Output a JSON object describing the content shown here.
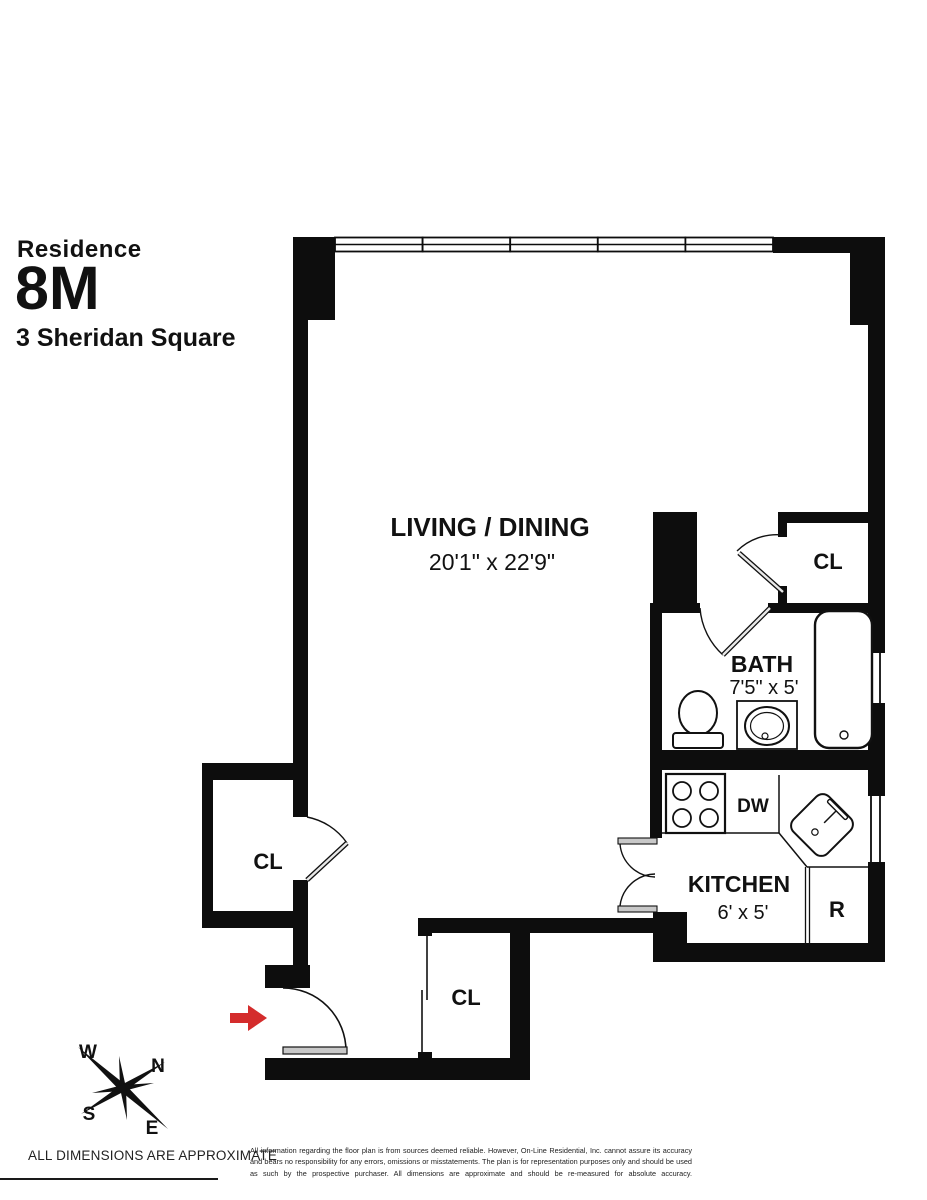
{
  "title": {
    "label": "Residence",
    "unit": "8M",
    "address": "3 Sheridan Square"
  },
  "rooms": {
    "living": {
      "name": "LIVING / DINING",
      "dims": "20'1\" x 22'9\""
    },
    "bath": {
      "name": "BATH",
      "dims": "7'5\" x 5'"
    },
    "kitchen": {
      "name": "KITCHEN",
      "dims": "6' x 5'"
    },
    "closet": "CL"
  },
  "labels": {
    "dishwasher": "DW",
    "refrigerator": "R"
  },
  "compass": {
    "west": "W",
    "north": "N",
    "south": "S",
    "east": "E"
  },
  "footer": {
    "note": "ALL DIMENSIONS ARE APPROXIMATE",
    "disclaimer": "All information regarding the floor plan is from sources deemed reliable. However, On-Line Residential, Inc. cannot assure its accuracy and bears no responsibility for any errors, omissions or misstatements. The plan is for representation purposes only and should be used as such by the prospective purchaser. All dimensions are approximate and should be re-measured for absolute accuracy."
  },
  "colors": {
    "wall": "#0d0d0d",
    "arrow": "#d42c2c"
  }
}
